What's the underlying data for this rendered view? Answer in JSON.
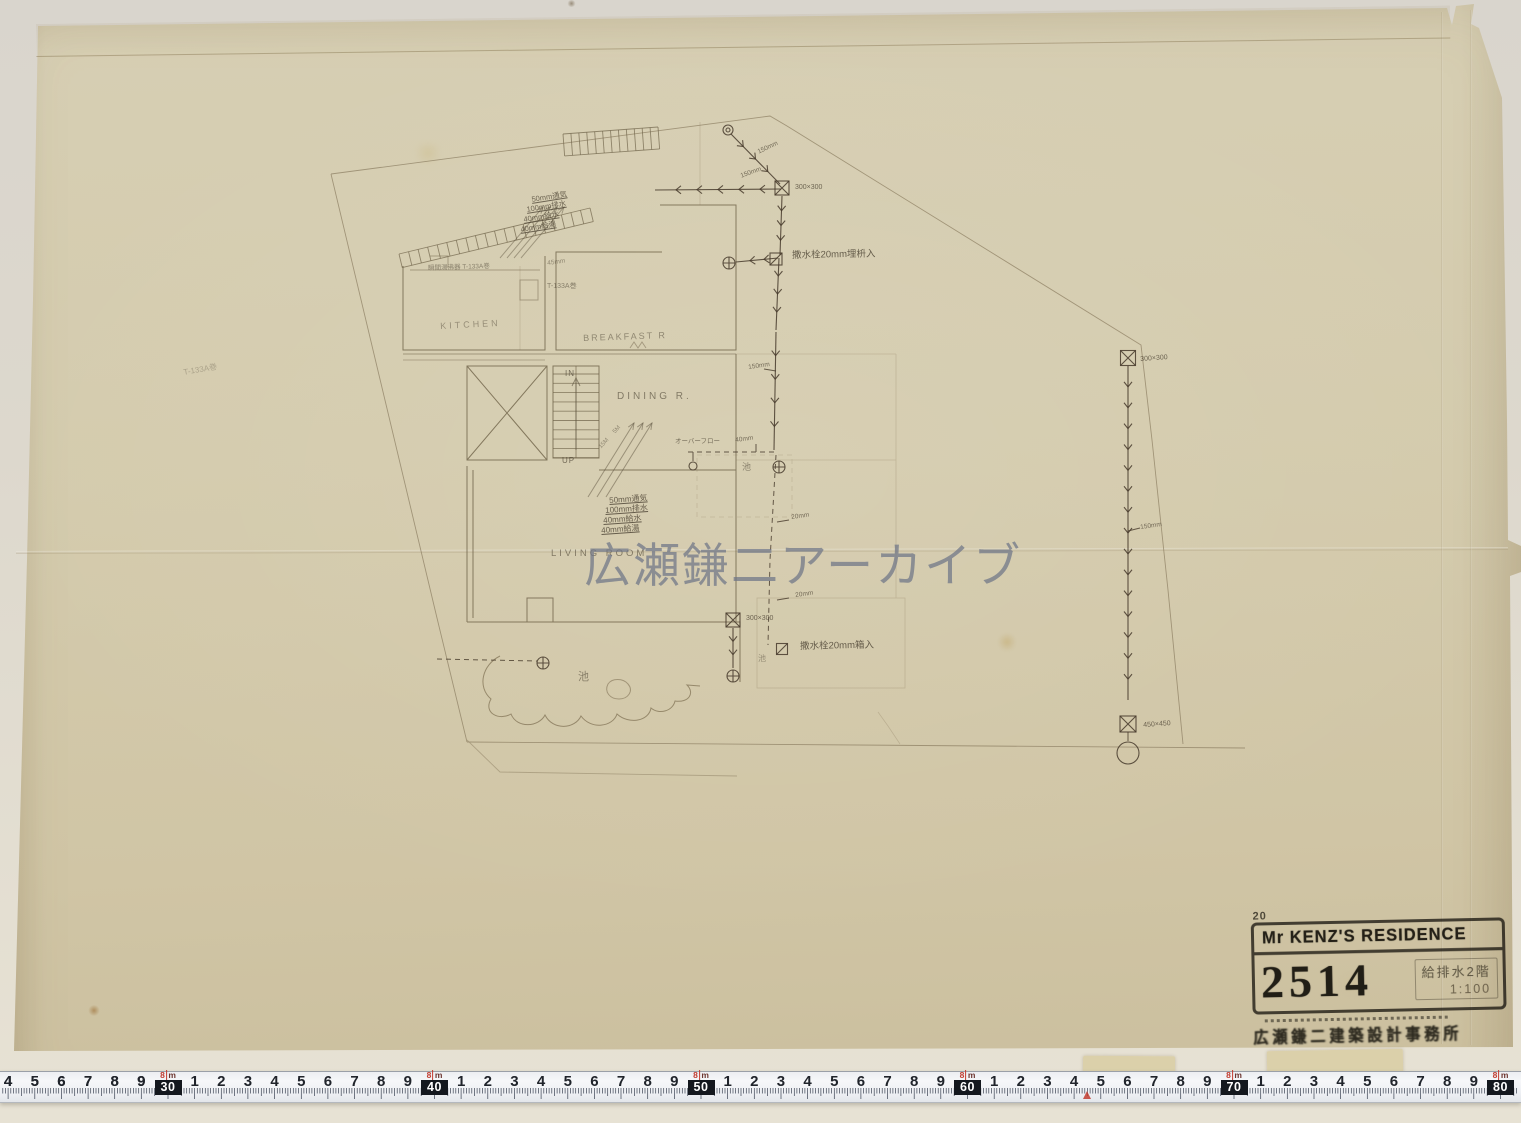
{
  "watermark": {
    "text": "広瀬鎌二アーカイブ",
    "color": "#6d7586"
  },
  "title_block": {
    "note_top": "20",
    "project": "Mr KENZ'S RESIDENCE",
    "drawing_number": "2514",
    "drawing_title": "給排水2階",
    "scale": "1:100",
    "firm": "広瀬鎌二建築設計事務所"
  },
  "plan": {
    "annotations": [
      {
        "t": "KITCHEN",
        "x": 440,
        "y": 322,
        "s": 9,
        "r": -3,
        "o": 0.45,
        "w": 3
      },
      {
        "t": "BREAKFAST R",
        "x": 583,
        "y": 334,
        "s": 9,
        "r": -2,
        "o": 0.5,
        "w": 2
      },
      {
        "t": "DINING R.",
        "x": 617,
        "y": 392,
        "s": 10,
        "r": 0,
        "o": 0.6,
        "w": 3
      },
      {
        "t": "LIVING ROOM",
        "x": 551,
        "y": 549,
        "s": 9.5,
        "r": 0,
        "o": 0.6,
        "w": 3
      },
      {
        "t": "IN",
        "x": 565,
        "y": 370,
        "s": 8,
        "r": 0,
        "o": 0.7,
        "w": 1
      },
      {
        "t": "UP",
        "x": 562,
        "y": 457,
        "s": 8,
        "r": 0,
        "o": 0.7,
        "w": 1
      },
      {
        "t": "50mm通気",
        "x": 531,
        "y": 196,
        "s": 7.5,
        "r": -9,
        "o": 0.75,
        "u": 1
      },
      {
        "t": "100mm排水",
        "x": 526,
        "y": 206,
        "s": 7.5,
        "r": -9,
        "o": 0.75,
        "u": 1
      },
      {
        "t": "40mm給水",
        "x": 523,
        "y": 216,
        "s": 7.5,
        "r": -9,
        "o": 0.75,
        "u": 1
      },
      {
        "t": "40mm給湯",
        "x": 520,
        "y": 226,
        "s": 7.5,
        "r": -9,
        "o": 0.75,
        "u": 1
      },
      {
        "t": "45mm",
        "x": 547,
        "y": 261,
        "s": 6.5,
        "r": -8,
        "o": 0.5
      },
      {
        "t": "50mm通気",
        "x": 609,
        "y": 497,
        "s": 8,
        "r": -4,
        "o": 0.8,
        "u": 1
      },
      {
        "t": "100mm排水",
        "x": 605,
        "y": 507,
        "s": 8,
        "r": -4,
        "o": 0.8,
        "u": 1
      },
      {
        "t": "40mm給水",
        "x": 603,
        "y": 517,
        "s": 8,
        "r": -4,
        "o": 0.8,
        "u": 1
      },
      {
        "t": "40mm給湯",
        "x": 601,
        "y": 527,
        "s": 8,
        "r": -4,
        "o": 0.8,
        "u": 1
      },
      {
        "t": "瞬間湯沸器 T-133A巻",
        "x": 428,
        "y": 266,
        "s": 6.5,
        "r": -2,
        "o": 0.55
      },
      {
        "t": "T-133A巻",
        "x": 547,
        "y": 283,
        "s": 7,
        "r": 0,
        "o": 0.55
      },
      {
        "t": "T-133A巻",
        "x": 183,
        "y": 369,
        "s": 8,
        "r": -10,
        "o": 0.3
      },
      {
        "t": "オーバーフロー",
        "x": 675,
        "y": 439,
        "s": 6.5,
        "r": 0,
        "o": 0.7
      },
      {
        "t": "40mm",
        "x": 735,
        "y": 438,
        "s": 6.5,
        "r": -8,
        "o": 0.7
      },
      {
        "t": "150mm",
        "x": 740,
        "y": 174,
        "s": 6.5,
        "r": -20,
        "o": 0.7
      },
      {
        "t": "150mm",
        "x": 757,
        "y": 150,
        "s": 6.5,
        "r": -25,
        "o": 0.7
      },
      {
        "t": "撒水栓20mm埋枡入",
        "x": 792,
        "y": 251,
        "s": 9.5,
        "r": -1,
        "o": 0.8
      },
      {
        "t": "撒水栓20mm箱入",
        "x": 800,
        "y": 642,
        "s": 9.5,
        "r": -1,
        "o": 0.8
      },
      {
        "t": "池",
        "x": 578,
        "y": 672,
        "s": 11,
        "r": 0,
        "o": 0.55
      },
      {
        "t": "池",
        "x": 742,
        "y": 463,
        "s": 9,
        "r": 0,
        "o": 0.55
      },
      {
        "t": "池",
        "x": 758,
        "y": 655,
        "s": 8,
        "r": 0,
        "o": 0.45
      },
      {
        "t": "150mm",
        "x": 748,
        "y": 365,
        "s": 6.5,
        "r": -8,
        "o": 0.7
      },
      {
        "t": "20mm",
        "x": 791,
        "y": 515,
        "s": 6.5,
        "r": -8,
        "o": 0.7
      },
      {
        "t": "20mm",
        "x": 795,
        "y": 593,
        "s": 6.5,
        "r": -8,
        "o": 0.7
      },
      {
        "t": "300×300",
        "x": 795,
        "y": 184,
        "s": 7,
        "r": 0,
        "o": 0.75
      },
      {
        "t": "300×300",
        "x": 746,
        "y": 615,
        "s": 7,
        "r": 0,
        "o": 0.75
      },
      {
        "t": "300×300",
        "x": 1140,
        "y": 356,
        "s": 7,
        "r": -4,
        "o": 0.75
      },
      {
        "t": "450×450",
        "x": 1143,
        "y": 722,
        "s": 7,
        "r": -4,
        "o": 0.75
      },
      {
        "t": "150mm",
        "x": 1140,
        "y": 525,
        "s": 6.5,
        "r": -8,
        "o": 0.7
      },
      {
        "t": "5M",
        "x": 612,
        "y": 431,
        "s": 6,
        "r": -48,
        "o": 0.5
      },
      {
        "t": "15M",
        "x": 598,
        "y": 446,
        "s": 6,
        "r": -48,
        "o": 0.5
      }
    ]
  },
  "ruler": {
    "meter_prefix": "8",
    "meter_unit": "m",
    "unit_step_px": 26.65,
    "majors": [
      {
        "label": "30",
        "x": 168
      },
      {
        "label": "40",
        "x": 434.5
      },
      {
        "label": "50",
        "x": 701
      },
      {
        "label": "60",
        "x": 967.5
      },
      {
        "label": "70",
        "x": 1234
      },
      {
        "label": "80",
        "x": 1500.5
      }
    ],
    "minor_digits": [
      "1",
      "2",
      "3",
      "4",
      "5",
      "6",
      "7",
      "8",
      "9"
    ],
    "red_marker_x": 1087
  }
}
